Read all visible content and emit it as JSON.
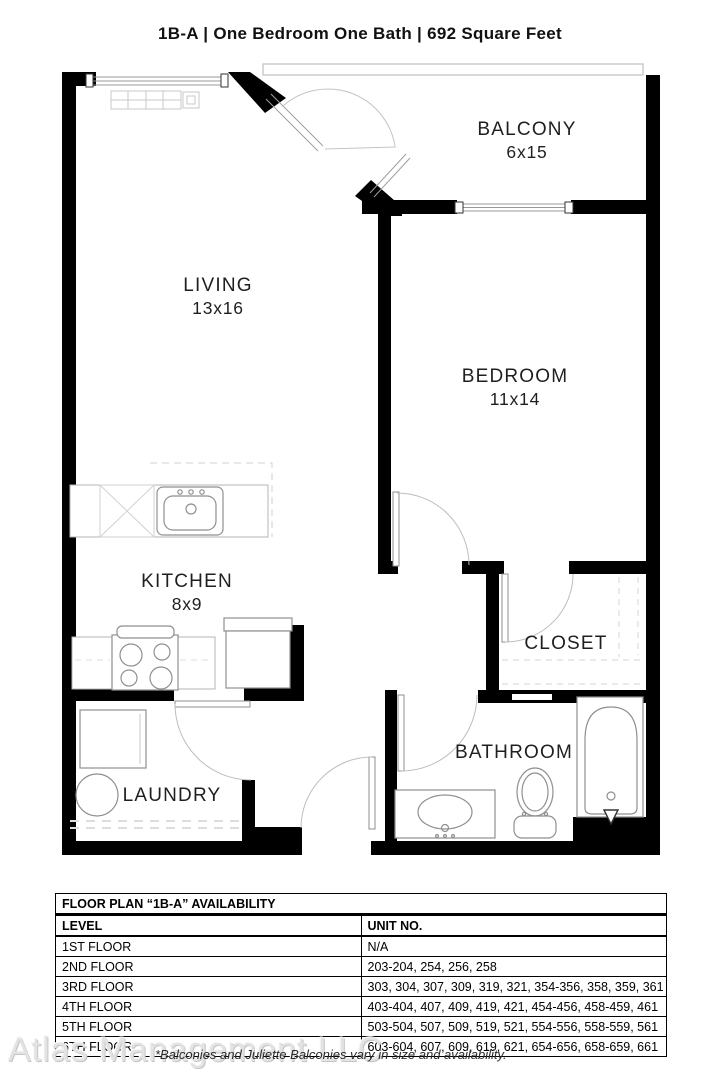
{
  "title": "1B-A  | One Bedroom One Bath |  692 Square Feet",
  "floor_plan": {
    "rooms": [
      {
        "name": "BALCONY",
        "dims": "6x15"
      },
      {
        "name": "LIVING",
        "dims": "13x16"
      },
      {
        "name": "BEDROOM",
        "dims": "11x14"
      },
      {
        "name": "KITCHEN",
        "dims": "8x9"
      },
      {
        "name": "CLOSET",
        "dims": ""
      },
      {
        "name": "LAUNDRY",
        "dims": ""
      },
      {
        "name": "BATHROOM",
        "dims": ""
      }
    ],
    "fixtures": [
      "heater",
      "kitchen-sink",
      "dishwasher",
      "stove",
      "refrigerator",
      "washer",
      "laundry-tub",
      "vanity-sink",
      "toilet",
      "bathtub"
    ]
  },
  "availability": {
    "header": "FLOOR PLAN “1B-A” AVAILABILITY",
    "columns": {
      "level": "LEVEL",
      "units": "UNIT NO."
    },
    "rows": [
      {
        "level": "1ST FLOOR",
        "units": "N/A"
      },
      {
        "level": "2ND FLOOR",
        "units": "203-204, 254, 256, 258"
      },
      {
        "level": "3RD FLOOR",
        "units": "303, 304, 307, 309, 319, 321, 354-356, 358, 359, 361"
      },
      {
        "level": "4TH FLOOR",
        "units": "403-404, 407, 409, 419, 421, 454-456, 458-459, 461"
      },
      {
        "level": "5TH FLOOR",
        "units": "503-504, 507, 509, 519, 521, 554-556, 558-559, 561"
      },
      {
        "level": "6TH FLOOR",
        "units": "603-604, 607, 609, 619, 621, 654-656, 658-659, 661"
      }
    ]
  },
  "watermark": "Atlas Management LLC",
  "footnote": "*Balconies and Juliette Balconies vary in size and availability.",
  "colors": {
    "wall": "#000000",
    "fixture": "#8f8f8f",
    "door_arc": "#bdbdbd",
    "text": "#1f1f1f",
    "watermark": "#e3e3e3"
  }
}
